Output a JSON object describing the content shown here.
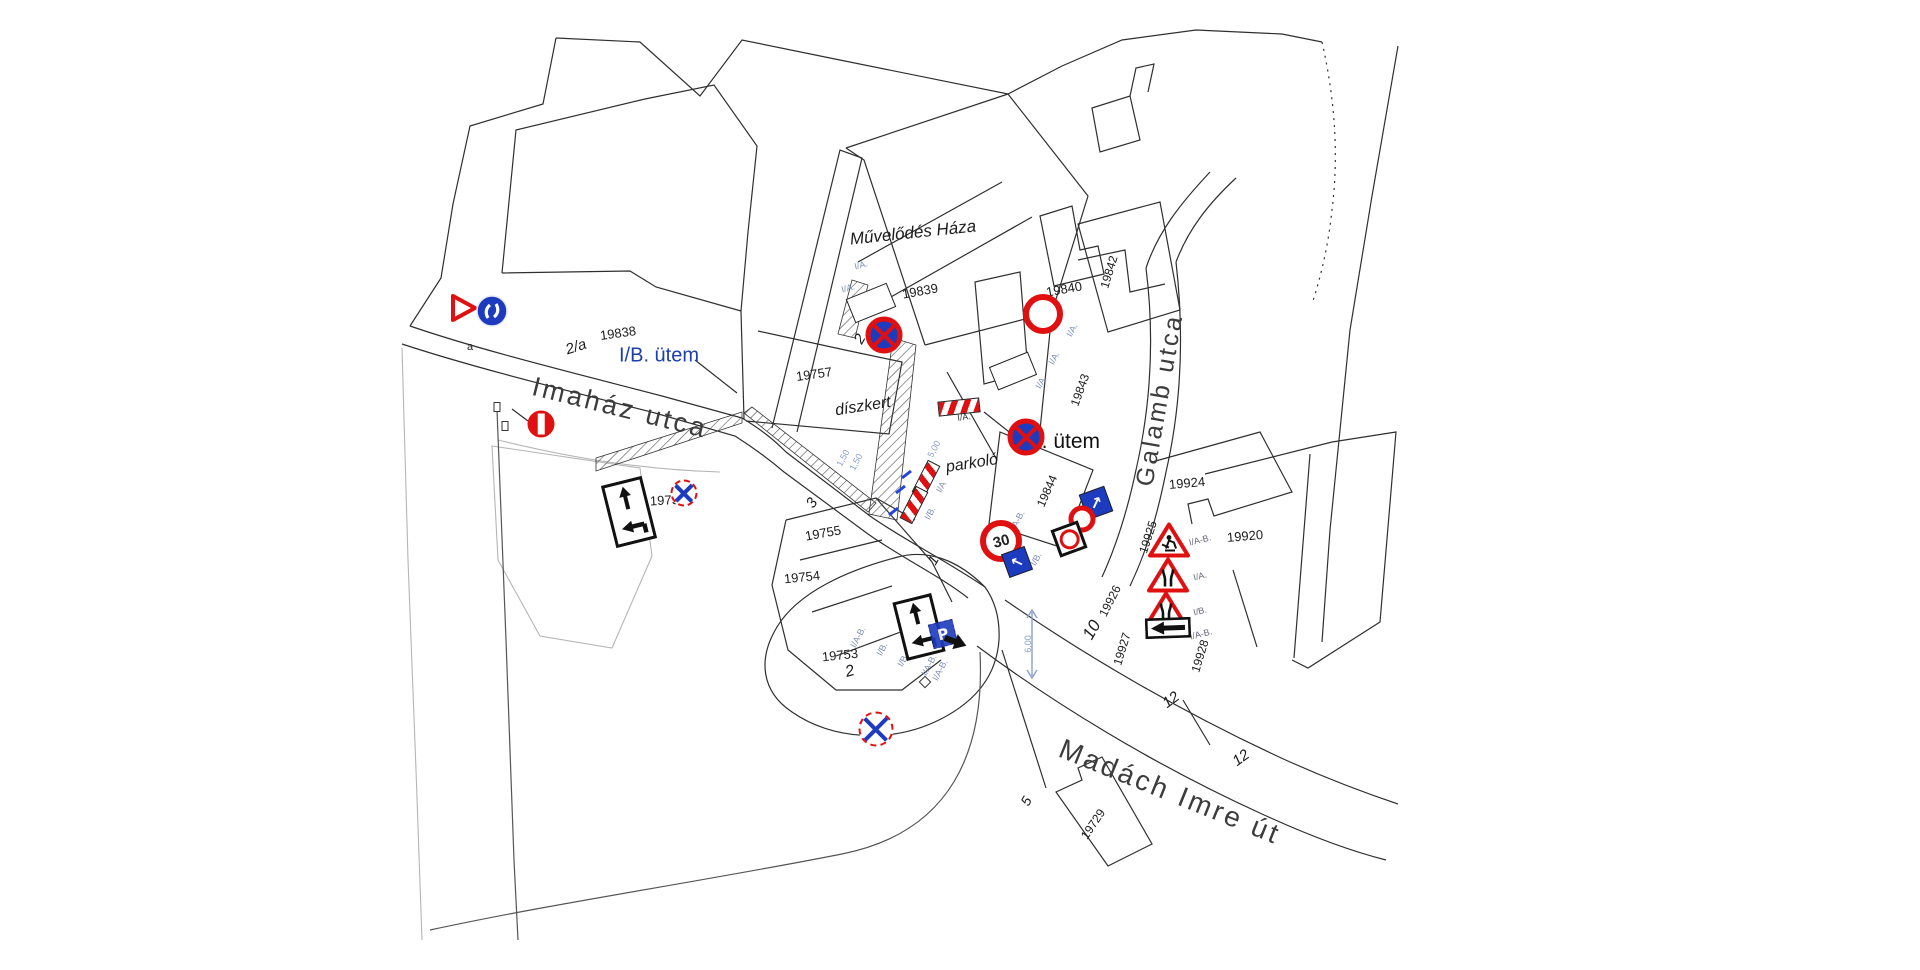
{
  "streets": {
    "imahaz": "Imaház utca",
    "galamb": "Galamb utca",
    "madach": "Madách Imre út"
  },
  "areas": {
    "culture_house": "Művelődés Háza",
    "garden": "díszkert",
    "parking": "parkoló"
  },
  "phases": {
    "ib": "I/B. ütem",
    "ia": "I/A. ütem"
  },
  "parcels": {
    "n19729": "19729",
    "n19753": "19753",
    "n19754": "19754",
    "n19755": "19755",
    "n19756": "19756",
    "n19757": "19757",
    "n19838": "19838",
    "n19839": "19839",
    "n19840": "19840",
    "n19842": "19842",
    "n19843": "19843",
    "n19844": "19844",
    "n19920": "19920",
    "n19924": "19924",
    "n19925": "19925",
    "n19926": "19926",
    "n19927": "19927",
    "n19928": "19928"
  },
  "house_numbers": {
    "h2a": "2/a",
    "h2": "2",
    "h1": "1",
    "h3": "3",
    "h5": "5",
    "h10": "10",
    "h12": "12",
    "ha": "a"
  },
  "sign_tags": {
    "ia": "I/A.",
    "ib": "I/B.",
    "iab": "I/A-B.",
    "ia_short": "I/A",
    "ib_short": "I/B"
  },
  "dimensions": {
    "d500": "5,00",
    "d150": "1,50",
    "d600": "6,00"
  },
  "sign_text": {
    "speed_limit": "30",
    "parking": "P"
  },
  "glyphs": {
    "arrow_ne": "↗",
    "arrow_nw": "↖"
  },
  "colors": {
    "sign_red": "#e01010",
    "sign_blue": "#1d3bbf",
    "phase_blue": "#1b3fae",
    "tag_blue": "#7d8fb5",
    "dim_blue": "#8aa0cc",
    "line_dark": "#2f2f2f",
    "line_gray": "#b5b5b5"
  }
}
